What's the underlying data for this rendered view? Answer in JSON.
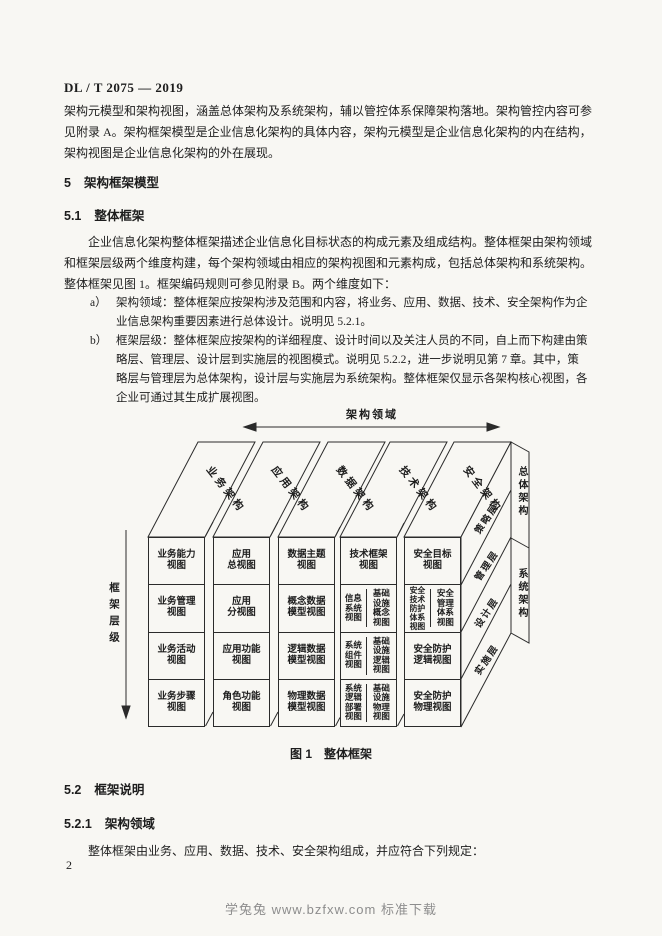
{
  "page": {
    "standard_number": "DL / T 2075 — 2019",
    "page_number": "2",
    "watermark": "学兔兔 www.bzfxw.com 标准下载"
  },
  "intro_paragraph": "架构元模型和架构视图，涵盖总体架构及系统架构，辅以管控体系保障架构落地。架构管控内容可参\n见附录 A。架构框架模型是企业信息化架构的具体内容，架构元模型是企业信息化架构的内在结构，\n架构视图是企业信息化架构的外在展现。",
  "sections": {
    "s5": {
      "number": "5",
      "title": "架构框架模型"
    },
    "s51": {
      "number": "5.1",
      "title": "整体框架",
      "paragraph": "企业信息化架构整体框架描述企业信息化目标状态的构成元素及组成结构。整体框架由架构领域\n和框架层级两个维度构建，每个架构领域由相应的架构视图和元素构成，包括总体架构和系统架构。\n整体框架见图 1。框架编码规则可参见附录 B。两个维度如下：",
      "items": [
        {
          "marker": "a）",
          "text": "架构领域：整体框架应按架构涉及范围和内容，将业务、应用、数据、技术、安全架构作为企\n业信息架构重要因素进行总体设计。说明见 5.2.1。"
        },
        {
          "marker": "b）",
          "text": "框架层级：整体框架应按架构的详细程度、设计时间以及关注人员的不同，自上而下构建由策\n略层、管理层、设计层到实施层的视图模式。说明见 5.2.2，进一步说明见第 7 章。其中，策\n略层与管理层为总体架构，设计层与实施层为系统架构。整体框架仅显示各架构核心视图，各\n企业可通过其生成扩展视图。"
        }
      ]
    },
    "s52": {
      "number": "5.2",
      "title": "框架说明"
    },
    "s521": {
      "number": "5.2.1",
      "title": "架构领域",
      "paragraph": "整体框架由业务、应用、数据、技术、安全架构组成，并应符合下列规定："
    }
  },
  "figure": {
    "caption": "图 1　整体框架",
    "top_axis_label": "架构领域",
    "left_axis_label": "框架层级",
    "domains": [
      "业务架构",
      "应用架构",
      "数据架构",
      "技术架构",
      "安全架构"
    ],
    "business_cells": [
      "业务能力\n视图",
      "业务管理\n视图",
      "业务活动\n视图",
      "业务步骤\n视图"
    ],
    "application_cells": [
      "应用\n总视图",
      "应用\n分视图",
      "应用功能\n视图",
      "角色功能\n视图"
    ],
    "data_cells": [
      "数据主题\n视图",
      "概念数据\n模型视图",
      "逻辑数据\n模型视图",
      "物理数据\n模型视图"
    ],
    "technology": {
      "row1": "技术框架\n视图",
      "rows": [
        [
          "信息\n系统\n视图",
          "基础\n设施\n概念\n视图"
        ],
        [
          "系统\n组件\n视图",
          "基础\n设施\n逻辑\n视图"
        ],
        [
          "系统\n逻辑\n部署\n视图",
          "基础\n设施\n物理\n视图"
        ]
      ]
    },
    "security": {
      "row1": "安全目标\n视图",
      "row2": [
        "安全\n技术\n防护\n体系\n视图",
        "安全\n管理\n体系\n视图"
      ],
      "row3": "安全防护\n逻辑视图",
      "row4": "安全防护\n物理视图"
    },
    "layers": [
      "策略层",
      "管理层",
      "设计层",
      "实施层"
    ],
    "architecture_groups": [
      "总体架构",
      "系统架构"
    ]
  }
}
